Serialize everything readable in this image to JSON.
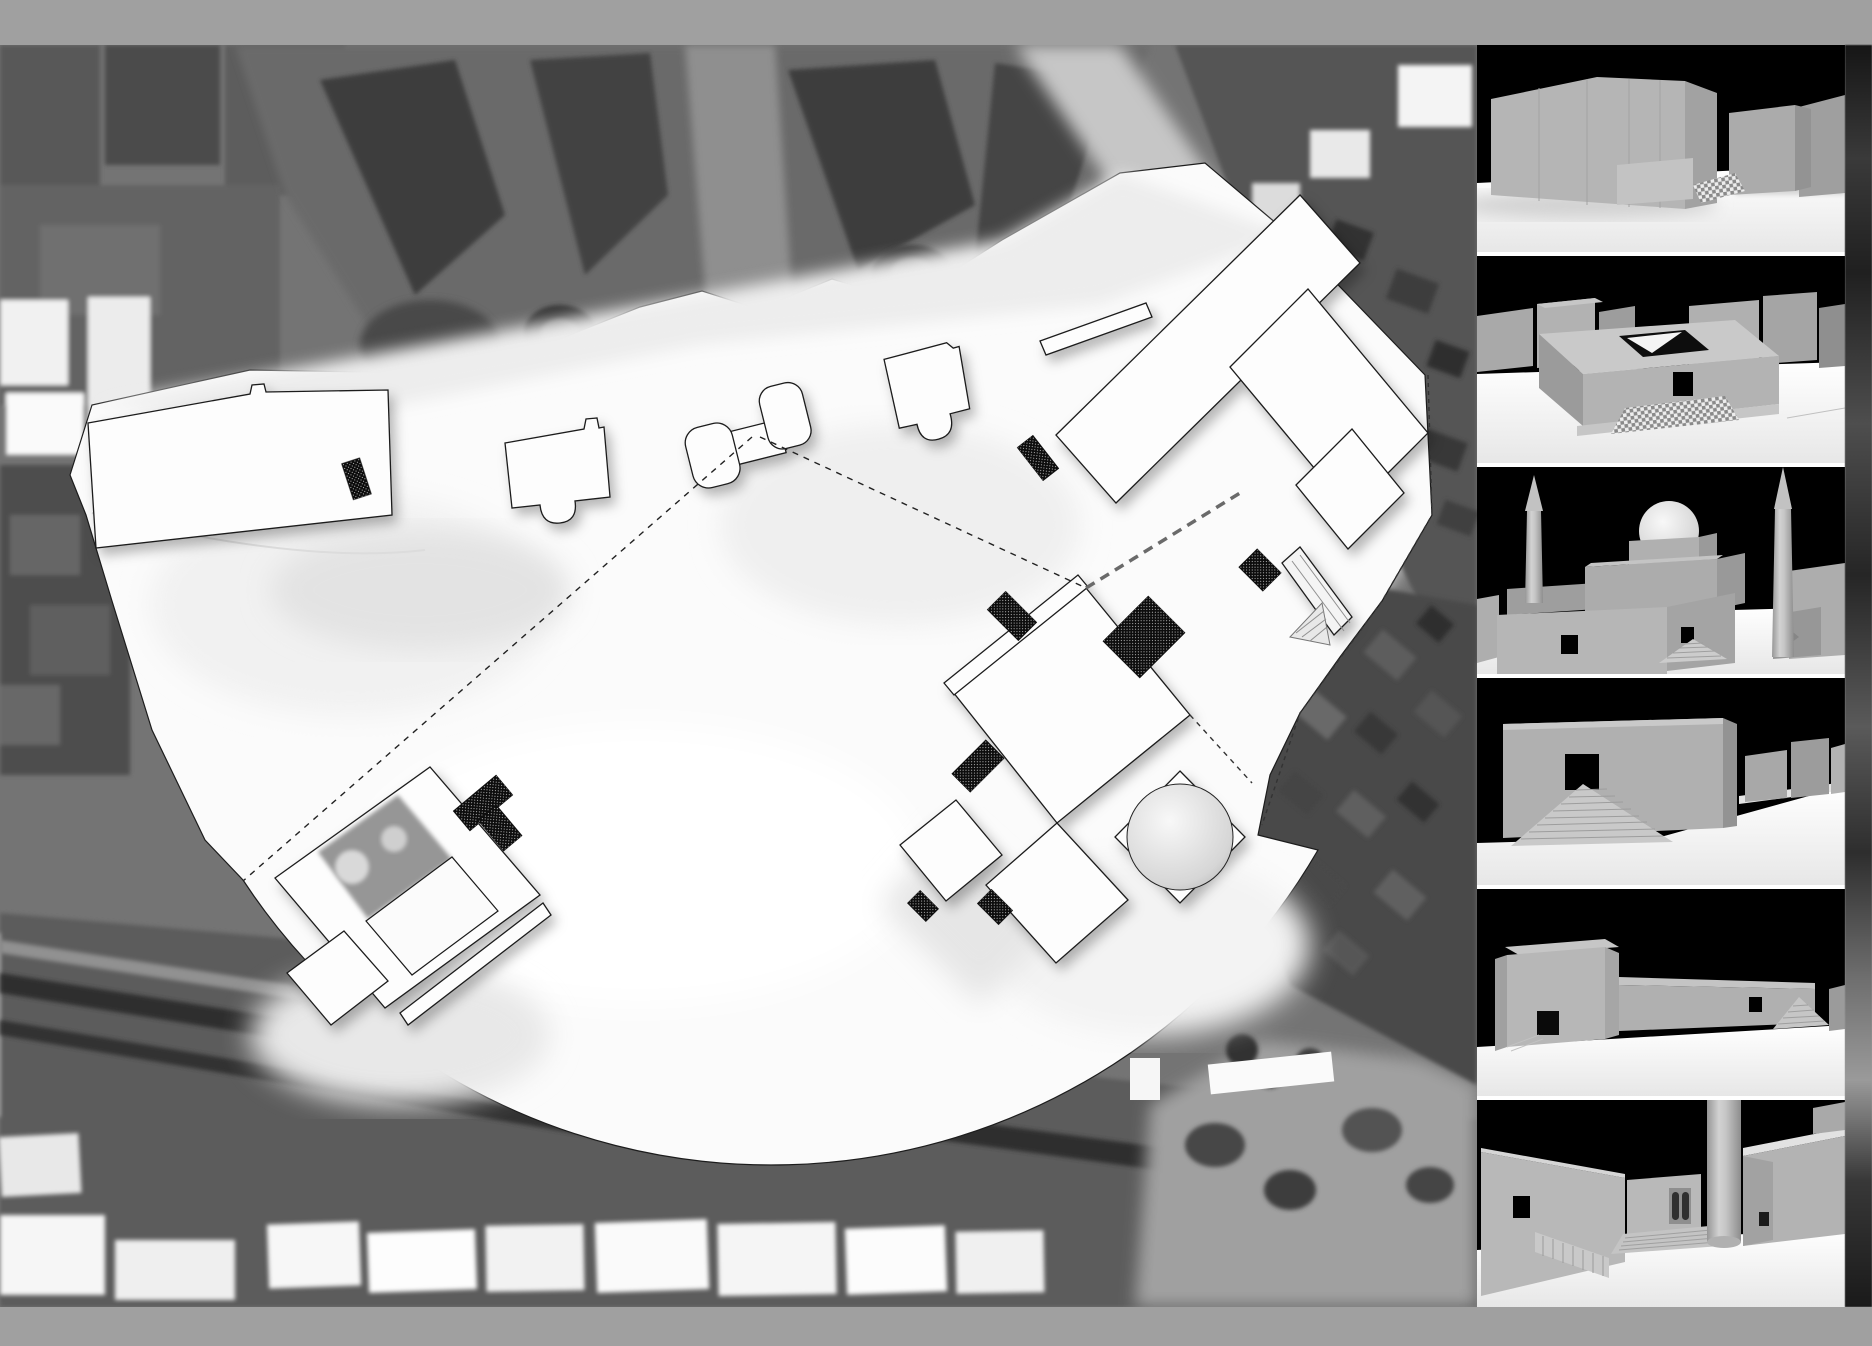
{
  "canvas": {
    "width": 1872,
    "height": 1346
  },
  "frame": {
    "color": "#a0a0a0",
    "top_bar_height": 45,
    "bottom_bar_height": 39
  },
  "site_plan": {
    "aria_label": "Grayscale aerial depth-map site plan: white view-cone plaza with outlined building footprints, dashed sight lines and cross-hatched entry markers, surrounded by dark city fabric",
    "palette": {
      "city_base": "#747474",
      "city_dark": "#3e3e3e",
      "city_light_block": "#8f8f8f",
      "road_light": "#c6c6c6",
      "plaza": "#fbfbfb",
      "footprint_fill": "#fdfdfd",
      "outline": "#1c1c1c",
      "hatch_marker": "#101010",
      "courtyard_gray": "#969696"
    },
    "features": {
      "view_cone": {
        "vertex_x": 752,
        "vertex_y": 437,
        "arc_radius": 632
      },
      "sight_line_count": 2,
      "hatched_marker_count": 9,
      "footprints": [
        "long-hall-northwest",
        "chapel-with-apse-north",
        "twin-pavilion-monument",
        "chapel-with-apse-center",
        "thin-stoa-slab",
        "angled-complex-northeast",
        "central-diamond-hall",
        "domed-rotunda",
        "courtyard-house-southwest"
      ]
    }
  },
  "render_strip": {
    "aria_label": "Column of six grayscale massing-model perspective renders with black sky and white ground",
    "background": "#ffffff",
    "sky": "#000000",
    "ground": "#f4f4f4",
    "massing_gray": "#b3b3b3",
    "thumbnails": [
      {
        "id": 1,
        "view": "blank-monolith-hall-street-view"
      },
      {
        "id": 2,
        "view": "courtyard-roof-lightwell-view"
      },
      {
        "id": 3,
        "view": "domed-sanctuary-with-two-minarets"
      },
      {
        "id": 4,
        "view": "long-wall-with-pyramid-stair"
      },
      {
        "id": 5,
        "view": "detached-box-and-precinct-wall"
      },
      {
        "id": 6,
        "view": "sunken-court-with-stairs-and-column"
      }
    ]
  },
  "edge_strip": {
    "aria_label": "cropped-dark-page-edge",
    "base": "#2a2a2a"
  }
}
